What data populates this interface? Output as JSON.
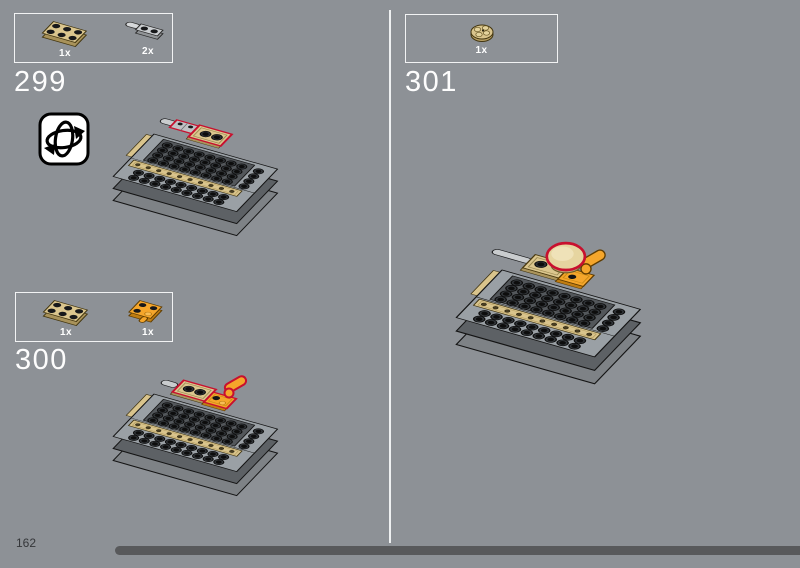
{
  "page": {
    "number": "162",
    "background_color": "#8d9196",
    "divider_color": "#eef0f1",
    "progress_bar_color": "#58595b",
    "highlight_outline_color": "#c8102e"
  },
  "steps": [
    {
      "number": "299",
      "has_rotate_icon": true,
      "parts": [
        {
          "label": "1x",
          "name": "tan-2x3-plate",
          "color": "#dbc68e"
        },
        {
          "label": "2x",
          "name": "gray-1x2-plate-with-handle",
          "color": "#cbced1"
        }
      ]
    },
    {
      "number": "300",
      "parts": [
        {
          "label": "1x",
          "name": "tan-2x3-plate",
          "color": "#dbc68e"
        },
        {
          "label": "1x",
          "name": "orange-2x2-plate-with-clip",
          "color": "#f5a62b"
        }
      ]
    },
    {
      "number": "301",
      "parts": [
        {
          "label": "1x",
          "name": "tan-2x2-round-plate",
          "color": "#d9c48c"
        }
      ]
    }
  ],
  "icons": {
    "rotate": "rotate-model-icon"
  },
  "colors": {
    "tan": "#d9c48c",
    "orange": "#f5a62b",
    "plate_gray": "#9aa0a5",
    "plate_dark": "#53575b"
  }
}
